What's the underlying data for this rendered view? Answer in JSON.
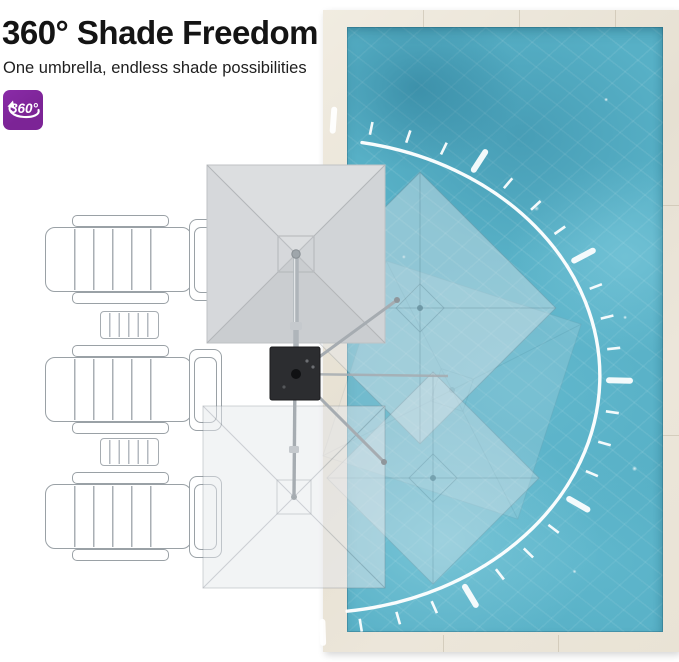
{
  "header": {
    "title": "360° Shade Freedom",
    "subtitle": "One umbrella, endless shade possibilities",
    "badge_label": "360°",
    "badge_icon": "360-rotation-arrow-icon"
  },
  "colors": {
    "badge_purple": "#7c2496",
    "pool_water": "#57b0c6",
    "pool_deck": "#ece6da",
    "canopy_gray": "#d2d5d8",
    "umbrella_base": "#2c2d30",
    "arc_white": "#ffffff",
    "title_black": "#141414"
  },
  "scene": {
    "rotation_arc_degrees": 360,
    "umbrella_positions_shown": 4,
    "lounge_chairs": 3,
    "side_tables": 2
  }
}
